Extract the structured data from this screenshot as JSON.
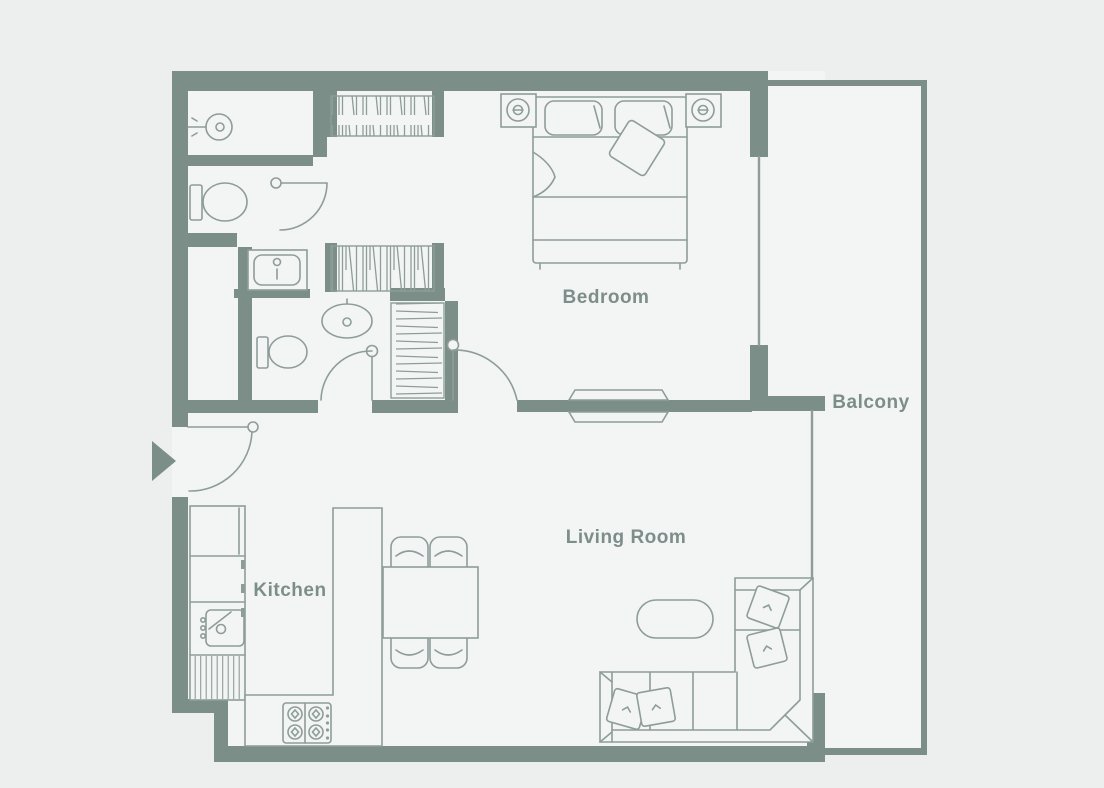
{
  "palette": {
    "bg": "#ecefee",
    "floor": "#f3f5f4",
    "wall": "#7b8e88",
    "line": "#8e9d99",
    "label": "#7d8e8a"
  },
  "floor_plan": {
    "type": "apartment-floor-plan",
    "rooms": [
      {
        "id": "bedroom",
        "label": "Bedroom"
      },
      {
        "id": "kitchen",
        "label": "Kitchen"
      },
      {
        "id": "living-room",
        "label": "Living Room"
      },
      {
        "id": "balcony",
        "label": "Balcony"
      }
    ],
    "fixtures": [
      "shower-icon",
      "toilet-icon",
      "vanity-sink-icon",
      "washbasin-icon",
      "wardrobe-icon",
      "linen-closet-icon",
      "double-bed-icon",
      "nightstand-lamp-icon",
      "tv-unit-icon",
      "sofa-icon",
      "coffee-table-icon",
      "dining-table-icon",
      "dining-chair-icon",
      "kitchen-counter-icon",
      "kitchen-sink-icon",
      "refrigerator-icon",
      "stove-icon",
      "door-swing-icon",
      "window-icon",
      "entry-arrow-icon"
    ]
  }
}
